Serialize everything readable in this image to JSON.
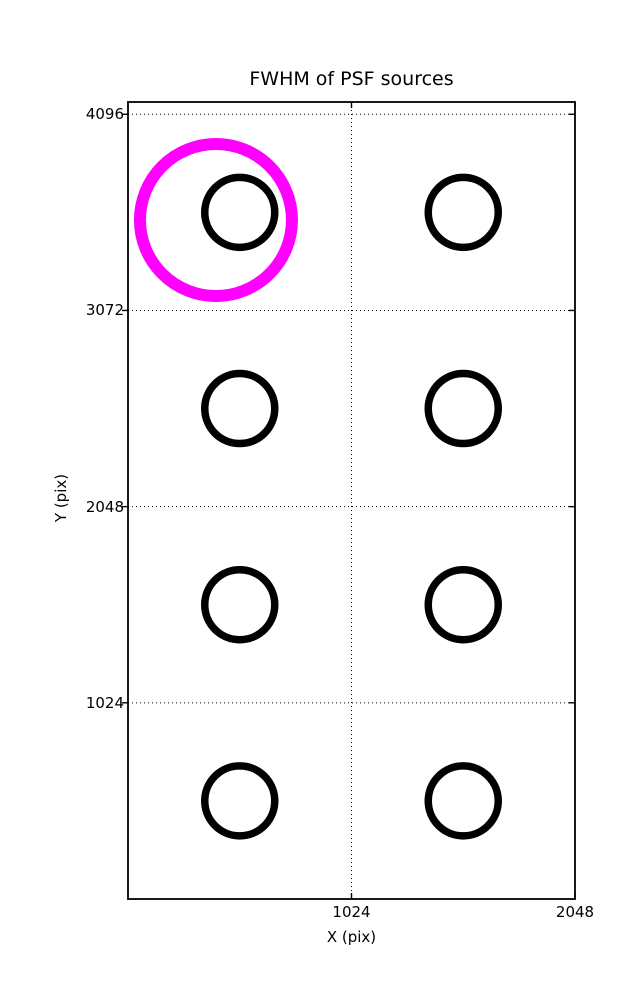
{
  "chart_data": {
    "type": "scatter",
    "title": "FWHM of PSF sources",
    "xlabel": "X (pix)",
    "ylabel": "Y (pix)",
    "xlim": [
      0,
      2048
    ],
    "ylim": [
      0,
      4160
    ],
    "xticks": [
      1024,
      2048
    ],
    "yticks": [
      1024,
      2048,
      3072,
      4096
    ],
    "grid": {
      "visible": true,
      "style": "dotted",
      "color": "#000000"
    },
    "axes_color": "#000000",
    "background_color": "#ffffff",
    "sources": [
      {
        "x": 512,
        "y": 3584
      },
      {
        "x": 1536,
        "y": 3584
      },
      {
        "x": 512,
        "y": 2560
      },
      {
        "x": 1536,
        "y": 2560
      },
      {
        "x": 512,
        "y": 1536
      },
      {
        "x": 1536,
        "y": 1536
      },
      {
        "x": 512,
        "y": 512
      },
      {
        "x": 1536,
        "y": 512
      }
    ],
    "marker": {
      "shape": "circle",
      "radius_px": 35,
      "stroke_px": 7.5,
      "color": "#000000",
      "fill": "none"
    },
    "highlight": {
      "x": 403,
      "y": 3544,
      "radius_px": 76,
      "stroke_px": 12,
      "color": "#ff00ff",
      "fill": "none"
    }
  }
}
